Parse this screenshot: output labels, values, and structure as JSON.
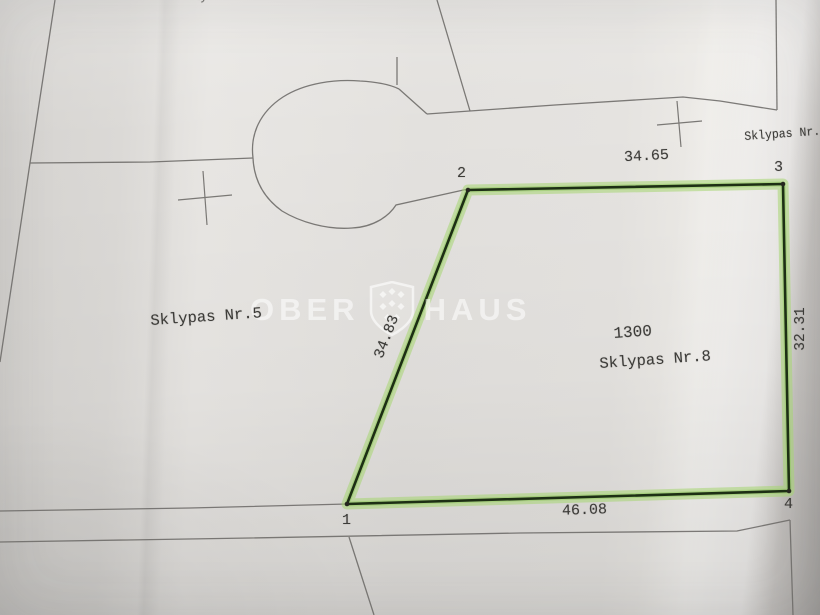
{
  "plan": {
    "plot": {
      "area": "1300",
      "name": "Sklypas Nr.8"
    },
    "neighbor_left": "Sklypas Nr.5",
    "neighbor_top_right": "Sklypas Nr.",
    "edge_top_partial": "Skly",
    "corner_labels": {
      "c1": "1",
      "c2": "2",
      "c3": "3",
      "c4": "4"
    },
    "dimensions": {
      "top": "34.65",
      "right": "32.31",
      "bottom": "46.08",
      "left": "34.83"
    }
  },
  "watermark": {
    "word_left": "OBER",
    "word_right": "HAUS",
    "logo": "oberhaus-shield-icon"
  },
  "colors": {
    "paper": "#e2e0dd",
    "line_gray": "#6f6d6a",
    "ink": "#3c3b38",
    "highlight_green": "#a6d671",
    "plot_line_dark": "#1d2f14",
    "watermark_white": "rgba(255,255,255,0.55)"
  }
}
